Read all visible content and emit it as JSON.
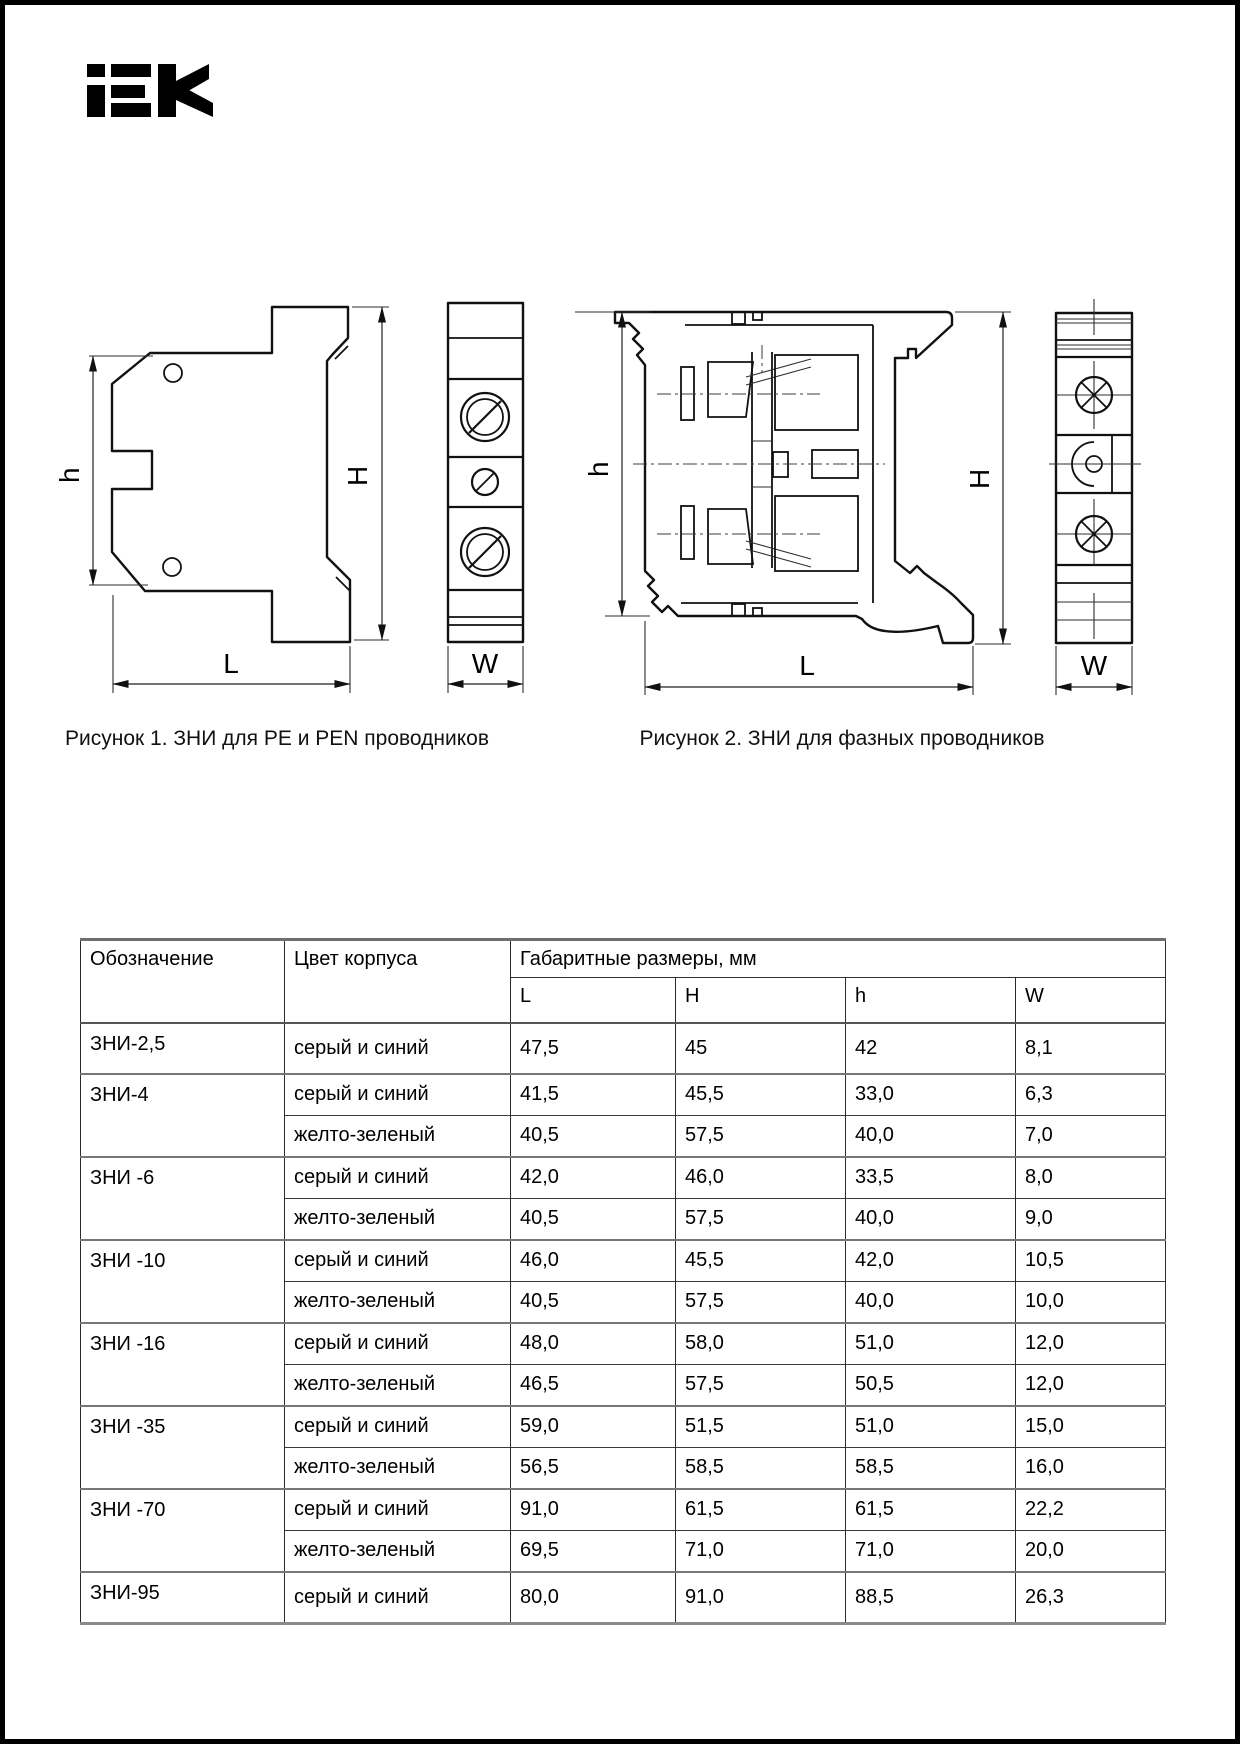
{
  "page": {
    "brand": "iEK",
    "ink_color": "#111111",
    "rule_gray": "#777777",
    "background": "#ffffff"
  },
  "figures": [
    {
      "caption": "Рисунок 1. ЗНИ для PE и PEN проводников",
      "dims": {
        "h": "h",
        "H": "H",
        "L": "L",
        "W": "W"
      }
    },
    {
      "caption": "Рисунок 2. ЗНИ для фазных проводников",
      "dims": {
        "h": "h",
        "H": "H",
        "L": "L",
        "W": "W"
      }
    }
  ],
  "table": {
    "headers": {
      "designation": "Обозначение",
      "body_color": "Цвет корпуса",
      "dims_group": "Габаритные размеры, мм",
      "dims": [
        "L",
        "H",
        "h",
        "W"
      ]
    },
    "rows": [
      {
        "model": "ЗНИ-2,5",
        "span": 1,
        "color": "серый и синий",
        "L": "47,5",
        "H": "45",
        "h": "42",
        "W": "8,1"
      },
      {
        "model": "ЗНИ-4",
        "span": 2,
        "color": "серый и синий",
        "L": "41,5",
        "H": "45,5",
        "h": "33,0",
        "W": "6,3"
      },
      {
        "color": "желто-зеленый",
        "L": "40,5",
        "H": "57,5",
        "h": "40,0",
        "W": "7,0"
      },
      {
        "model": "ЗНИ -6",
        "span": 2,
        "color": "серый и синий",
        "L": "42,0",
        "H": "46,0",
        "h": "33,5",
        "W": "8,0"
      },
      {
        "color": "желто-зеленый",
        "L": "40,5",
        "H": "57,5",
        "h": "40,0",
        "W": "9,0"
      },
      {
        "model": "ЗНИ -10",
        "span": 2,
        "color": "серый и синий",
        "L": "46,0",
        "H": "45,5",
        "h": "42,0",
        "W": "10,5"
      },
      {
        "color": "желто-зеленый",
        "L": "40,5",
        "H": "57,5",
        "h": "40,0",
        "W": "10,0"
      },
      {
        "model": "ЗНИ -16",
        "span": 2,
        "color": "серый и синий",
        "L": "48,0",
        "H": "58,0",
        "h": "51,0",
        "W": "12,0"
      },
      {
        "color": "желто-зеленый",
        "L": "46,5",
        "H": "57,5",
        "h": "50,5",
        "W": "12,0"
      },
      {
        "model": "ЗНИ -35",
        "span": 2,
        "color": "серый и синий",
        "L": "59,0",
        "H": "51,5",
        "h": "51,0",
        "W": "15,0"
      },
      {
        "color": "желто-зеленый",
        "L": "56,5",
        "H": "58,5",
        "h": "58,5",
        "W": "16,0"
      },
      {
        "model": "ЗНИ -70",
        "span": 2,
        "color": "серый и синий",
        "L": "91,0",
        "H": "61,5",
        "h": "61,5",
        "W": "22,2"
      },
      {
        "color": "желто-зеленый",
        "L": "69,5",
        "H": "71,0",
        "h": "71,0",
        "W": "20,0"
      },
      {
        "model": "ЗНИ-95",
        "span": 1,
        "color": "серый и синий",
        "L": "80,0",
        "H": "91,0",
        "h": "88,5",
        "W": "26,3"
      }
    ]
  }
}
